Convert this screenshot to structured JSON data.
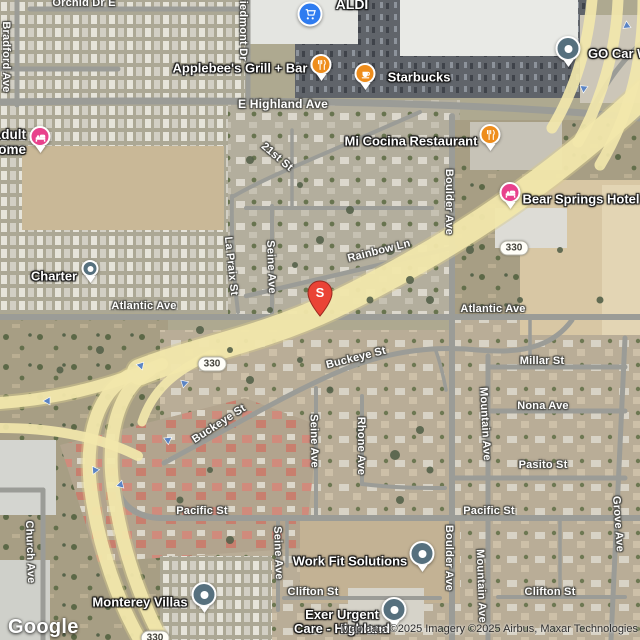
{
  "attribution": {
    "logo": "Google",
    "copyright": "Map data ©2025 Imagery ©2025 Airbus, Maxar Technologies"
  },
  "marker": {
    "label": "S"
  },
  "shield": {
    "label": "330"
  },
  "colors": {
    "restaurant_pin": "#ee8d1c",
    "lodging_pin": "#e8418c",
    "generic_pin": "#56707e",
    "aldi_pin": "#2f7cf0",
    "marker_red": "#ea4335",
    "freeway_overlay": "#f2e7ab",
    "road_gray": "#9b9c97",
    "arrow_blue": "#5b84c4"
  },
  "streets": {
    "orchid_dr_e": "Orchid Dr E",
    "bradford_ave": "Bradford Ave",
    "piedmont_dr": "Piedmont Dr",
    "e_highland_ave": "E Highland Ave",
    "st_21st": "21st St",
    "rainbow_ln": "Rainbow Ln",
    "la_praix_st": "La Praix St",
    "seine_ave_upper": "Seine Ave",
    "boulder_ave_upper": "Boulder Ave",
    "atlantic_ave_left": "Atlantic Ave",
    "atlantic_ave_right": "Atlantic Ave",
    "millar_st": "Millar St",
    "nona_ave": "Nona Ave",
    "mountain_ave_upper": "Mountain Ave",
    "pasito_st": "Pasito St",
    "grove_ave": "Grove Ave",
    "buckeye_st_upper": "Buckeye St",
    "buckeye_st_lower": "Buckeye St",
    "seine_ave_mid": "Seine Ave",
    "rhone_ave": "Rhone Ave",
    "pacific_st_left": "Pacific St",
    "pacific_st_right": "Pacific St",
    "church_ave": "Church Ave",
    "clifton_st_left": "Clifton St",
    "clifton_st_right": "Clifton St",
    "seine_ave_lower": "Seine Ave",
    "boulder_ave_lower": "Boulder Ave",
    "mountain_ave_lower": "Mountain Ave"
  },
  "pois": {
    "aldi": {
      "name": "ALDI"
    },
    "applebees": {
      "name": "Applebee's Grill + Bar"
    },
    "starbucks": {
      "name": "Starbucks"
    },
    "go_car_wash": {
      "name": "GO Car Wash"
    },
    "mi_cocina": {
      "name": "Mi Cocina Restaurant"
    },
    "bear_springs": {
      "name": "Bear Springs Hotel"
    },
    "adult_home": {
      "line1": "Adult",
      "line2": "Home"
    },
    "charter": {
      "name": "Charter"
    },
    "monterey_villas": {
      "name": "Monterey Villas"
    },
    "work_fit": {
      "name": "Work Fit Solutions"
    },
    "exer_urgent_care": {
      "line1": "Exer Urgent",
      "line2": "Care - Highland"
    }
  }
}
